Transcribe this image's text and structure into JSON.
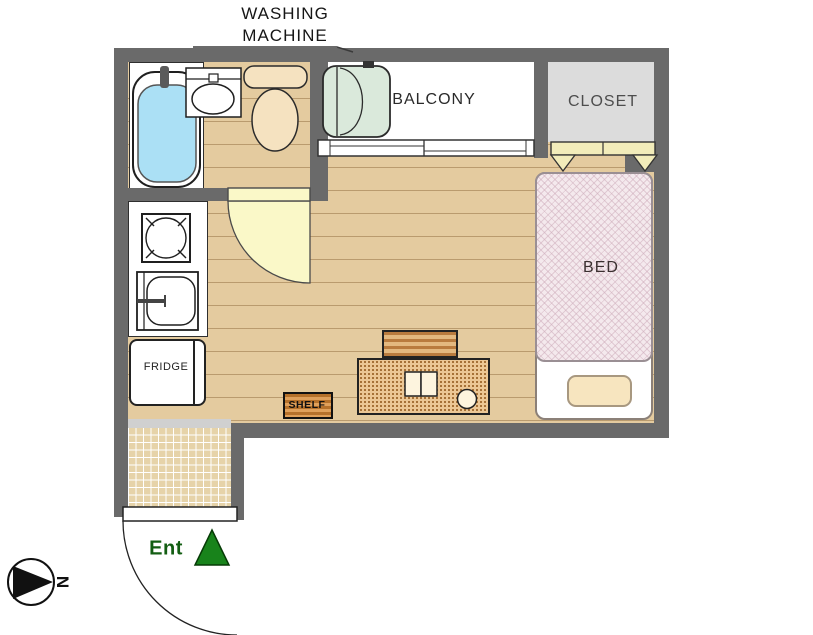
{
  "plan": {
    "rooms": {
      "balcony": "BALCONY",
      "closet": "CLOSET",
      "bed": "BED",
      "fridge": "FRIDGE",
      "shelf": "SHELF",
      "entrance": "Ent"
    },
    "annotations": {
      "washing_machine_line1": "WASHING",
      "washing_machine_line2": "MACHINE",
      "north": "N"
    },
    "colors": {
      "wall": "#6A6A6A",
      "wood_floor": "#E4CB9F",
      "tub_water": "#ABE0F5",
      "washer_green": "#DAE9DB",
      "closet_fill": "#DCDCDC",
      "bed_fill": "#F4E9ED",
      "door_fill": "#FAF8C8",
      "entrance_green": "#18831B"
    }
  }
}
